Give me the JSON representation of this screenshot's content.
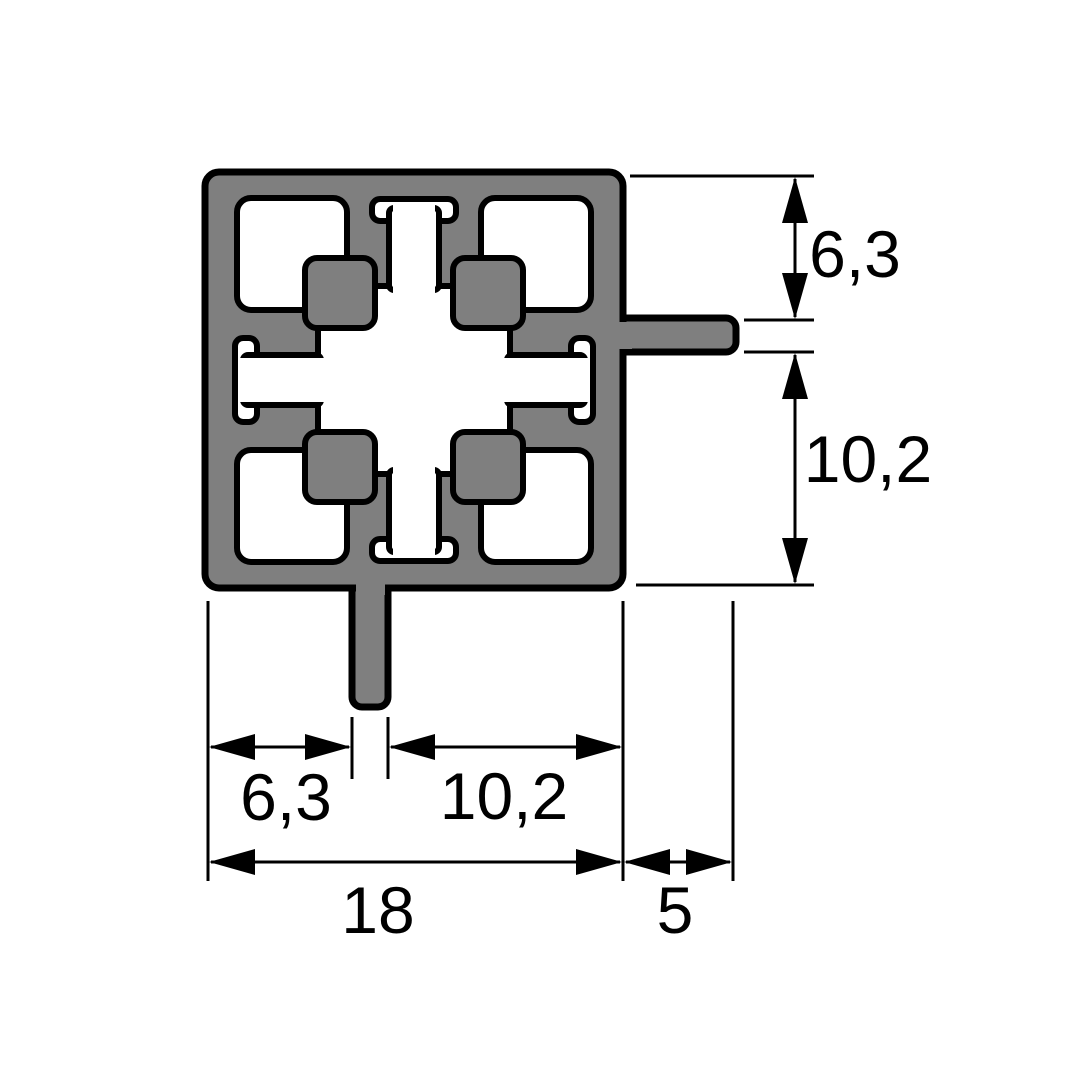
{
  "drawing": {
    "title": "aluminium-profile-cross-section",
    "colors": {
      "profile_fill": "#7F7F7F",
      "outline": "#000000",
      "background": "#FFFFFF",
      "dimension_color": "#000000"
    },
    "dimensions": {
      "side_top": {
        "label": "6,3"
      },
      "side_bottom": {
        "label": "10,2"
      },
      "bottom_left": {
        "label": "6,3"
      },
      "bottom_middle": {
        "label": "10,2"
      },
      "bottom_overall": {
        "label": "18"
      },
      "tab_projection": {
        "label": "5"
      }
    }
  }
}
